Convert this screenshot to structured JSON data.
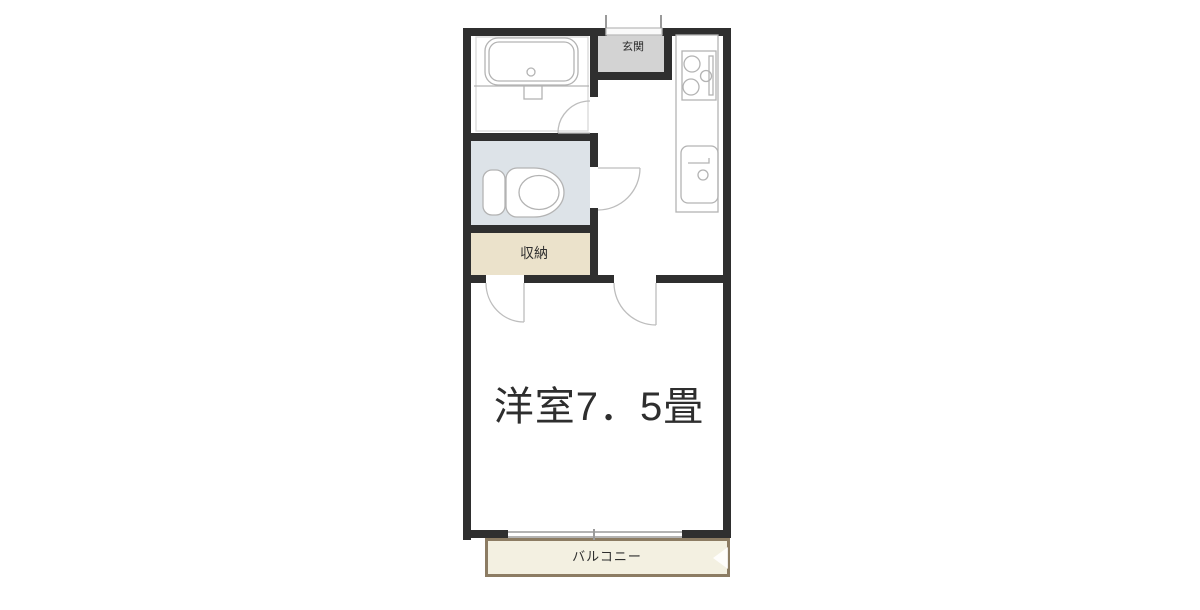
{
  "floor_plan": {
    "kind": "japanese-apartment-floorplan",
    "labels": {
      "entrance": "玄関",
      "storage": "収納",
      "main_room": "洋室7．5畳",
      "balcony": "バルコニー"
    },
    "colors": {
      "wall": "#2f2f2f",
      "entrance_fill": "#d3d3d3",
      "toilet_fill": "#dde3e8",
      "storage_fill": "#ebe2cb",
      "balcony_fill": "#f3f0e1",
      "balcony_border": "#8c7c63",
      "fixture_stroke": "#b3b3b3",
      "door_stroke": "#bdbdbd",
      "inner_outline": "#d9d9d9",
      "label_text": "#2e2e2e"
    }
  }
}
